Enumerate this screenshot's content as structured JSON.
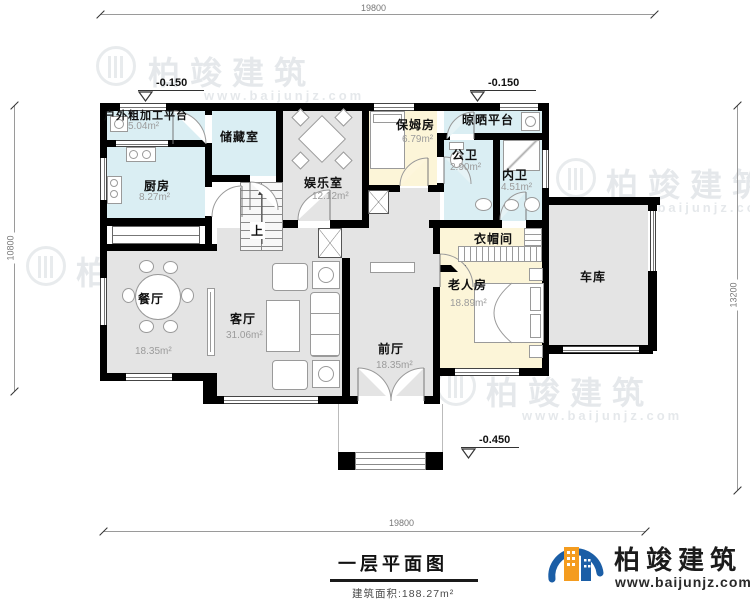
{
  "title": {
    "text": "一层平面图",
    "total_area": "建筑面积:188.27m²"
  },
  "brand": {
    "name": "柏竣建筑",
    "url": "www.baijunjz.com"
  },
  "dimensions": {
    "top": "19800",
    "bottom": "19800",
    "left": "10800",
    "right": "13200"
  },
  "elevations": {
    "left_top": "-0.150",
    "right_top": "-0.150",
    "entry": "±0.000",
    "porch": "-0.450"
  },
  "stairs": {
    "up_label": "上"
  },
  "rooms": [
    {
      "id": "outdoor-platform",
      "name": "户外粗加工平台",
      "area": "5.04m²"
    },
    {
      "id": "kitchen",
      "name": "厨房",
      "area": "8.27m²"
    },
    {
      "id": "storage",
      "name": "储藏室",
      "area": ""
    },
    {
      "id": "entertainment",
      "name": "娱乐室",
      "area": "12.12m²"
    },
    {
      "id": "nanny-room",
      "name": "保姆房",
      "area": "6.79m²"
    },
    {
      "id": "drying-platform",
      "name": "晾晒平台",
      "area": ""
    },
    {
      "id": "public-bath",
      "name": "公卫",
      "area": "2.90m²"
    },
    {
      "id": "private-bath",
      "name": "内卫",
      "area": "4.51m²"
    },
    {
      "id": "cloakroom",
      "name": "衣帽间",
      "area": ""
    },
    {
      "id": "elder-room",
      "name": "老人房",
      "area": "18.89m²"
    },
    {
      "id": "garage",
      "name": "车库",
      "area": ""
    },
    {
      "id": "dining-room",
      "name": "餐厅",
      "area": "18.35m²"
    },
    {
      "id": "living-room",
      "name": "客厅",
      "area": "31.06m²"
    },
    {
      "id": "foyer",
      "name": "前厅",
      "area": "18.35m²"
    }
  ],
  "colors": {
    "wall": "#000000",
    "fill_gray": "#e4e4e4",
    "fill_blue": "#daeef3",
    "fill_cream": "#fcf5d8",
    "logo_blue": "#1b5ea6",
    "logo_orange": "#f49c1f"
  }
}
